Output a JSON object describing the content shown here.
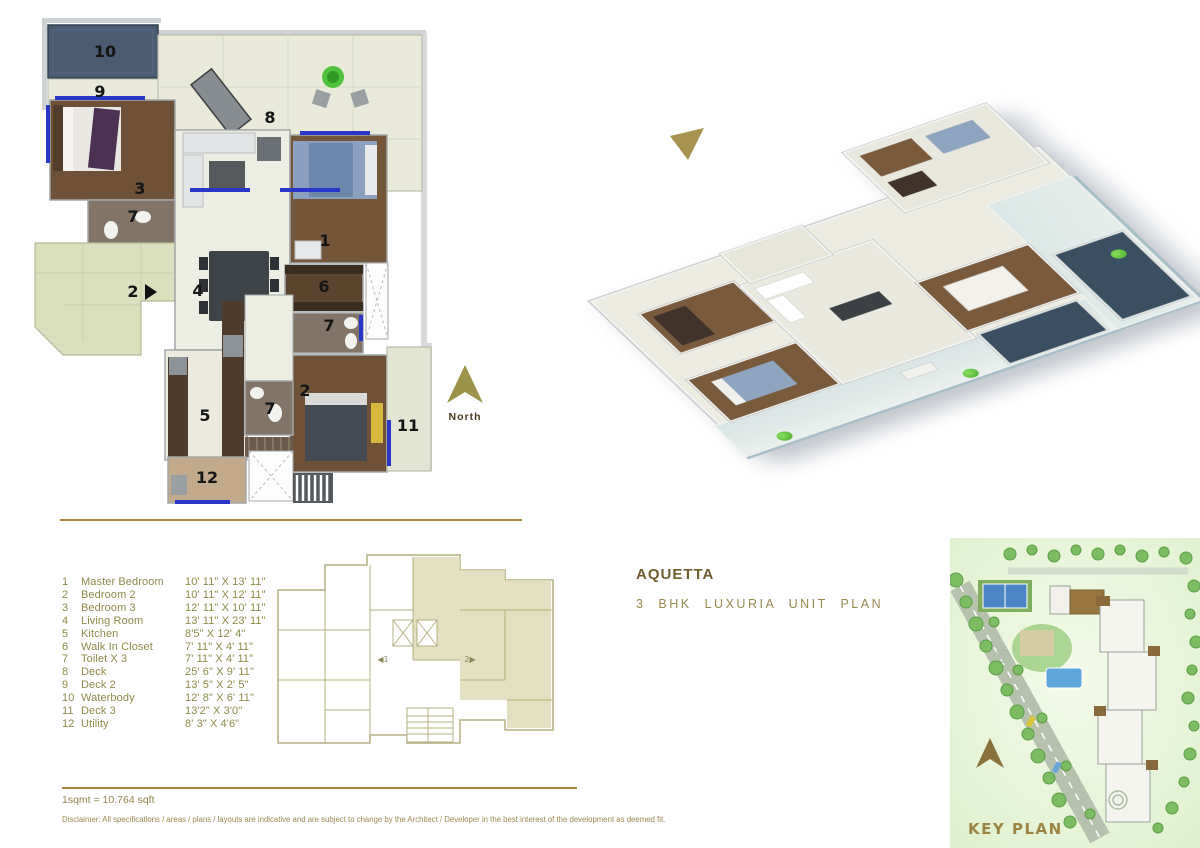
{
  "title": {
    "name": "AQUETTA",
    "subtitle": "3 BHK  LUXURIA  UNIT  PLAN"
  },
  "north": {
    "label": "North"
  },
  "key_plan": {
    "label": "KEY PLAN"
  },
  "legend": {
    "note": "1sqmt = 10.764 sqft",
    "items": [
      {
        "num": "1",
        "name": "Master Bedroom",
        "dim": "10' 11\" X 13' 11\""
      },
      {
        "num": "2",
        "name": "Bedroom 2",
        "dim": "10' 11\" X 12' 11\""
      },
      {
        "num": "3",
        "name": "Bedroom 3",
        "dim": "12' 11\" X 10' 11\""
      },
      {
        "num": "4",
        "name": "Living Room",
        "dim": "13' 11\" X 23' 11\""
      },
      {
        "num": "5",
        "name": "Kitchen",
        "dim": "8'5\" X 12' 4\""
      },
      {
        "num": "6",
        "name": "Walk In Closet",
        "dim": "7' 11\" X 4' 11\""
      },
      {
        "num": "7",
        "name": "Toilet  X 3",
        "dim": "7' 11\" X 4' 11\""
      },
      {
        "num": "8",
        "name": "Deck",
        "dim": "25' 6\" X 9' 11\""
      },
      {
        "num": "9",
        "name": "Deck 2",
        "dim": "13' 5\" X 2' 5\""
      },
      {
        "num": "10",
        "name": "Waterbody",
        "dim": "12' 8\" X 6' 11\""
      },
      {
        "num": "11",
        "name": "Deck 3",
        "dim": "13'2\" X 3'0\""
      },
      {
        "num": "12",
        "name": "Utility",
        "dim": "8' 3\" X 4'6\""
      }
    ]
  },
  "plan": {
    "labels": [
      "10",
      "9",
      "8",
      "3",
      "7",
      "1",
      "2",
      "4",
      "6",
      "7",
      "2",
      "11",
      "5",
      "7",
      "12"
    ]
  },
  "floor_key": {
    "unit1": "◀1",
    "unit2": "2▶"
  },
  "disclaimer": "Disclaimer: All specifications / areas / plans / layouts are indicative and are subject to change by the Architect / Developer in the best interest of the development as deemed fit.",
  "colors": {
    "accent_gold": "#a8873d",
    "legend_olive": "#8f8a49",
    "pool_blue": "#44566c",
    "window_blue": "#2837c8"
  }
}
